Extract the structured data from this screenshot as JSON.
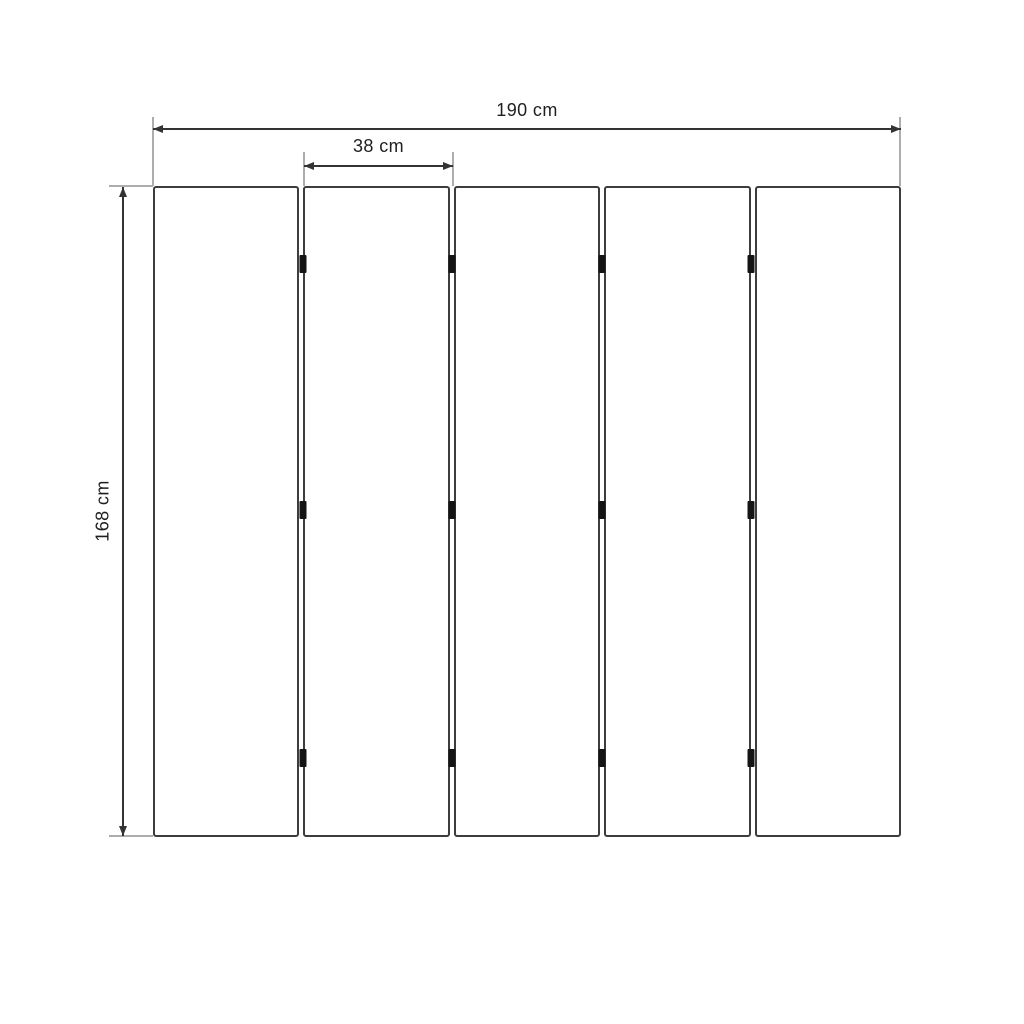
{
  "labels": {
    "total_width": "190 cm",
    "panel_width": "38 cm",
    "height": "168 cm"
  },
  "structure": {
    "panel_count": 5,
    "gap_count": 4,
    "hinges_per_gap": 3
  },
  "colors": {
    "background": "#ffffff",
    "panel_border": "#3d3d3d",
    "dimension_line": "#333333",
    "extension_line": "#adadad",
    "hinge": "#141414",
    "text": "#1f1f1f"
  }
}
